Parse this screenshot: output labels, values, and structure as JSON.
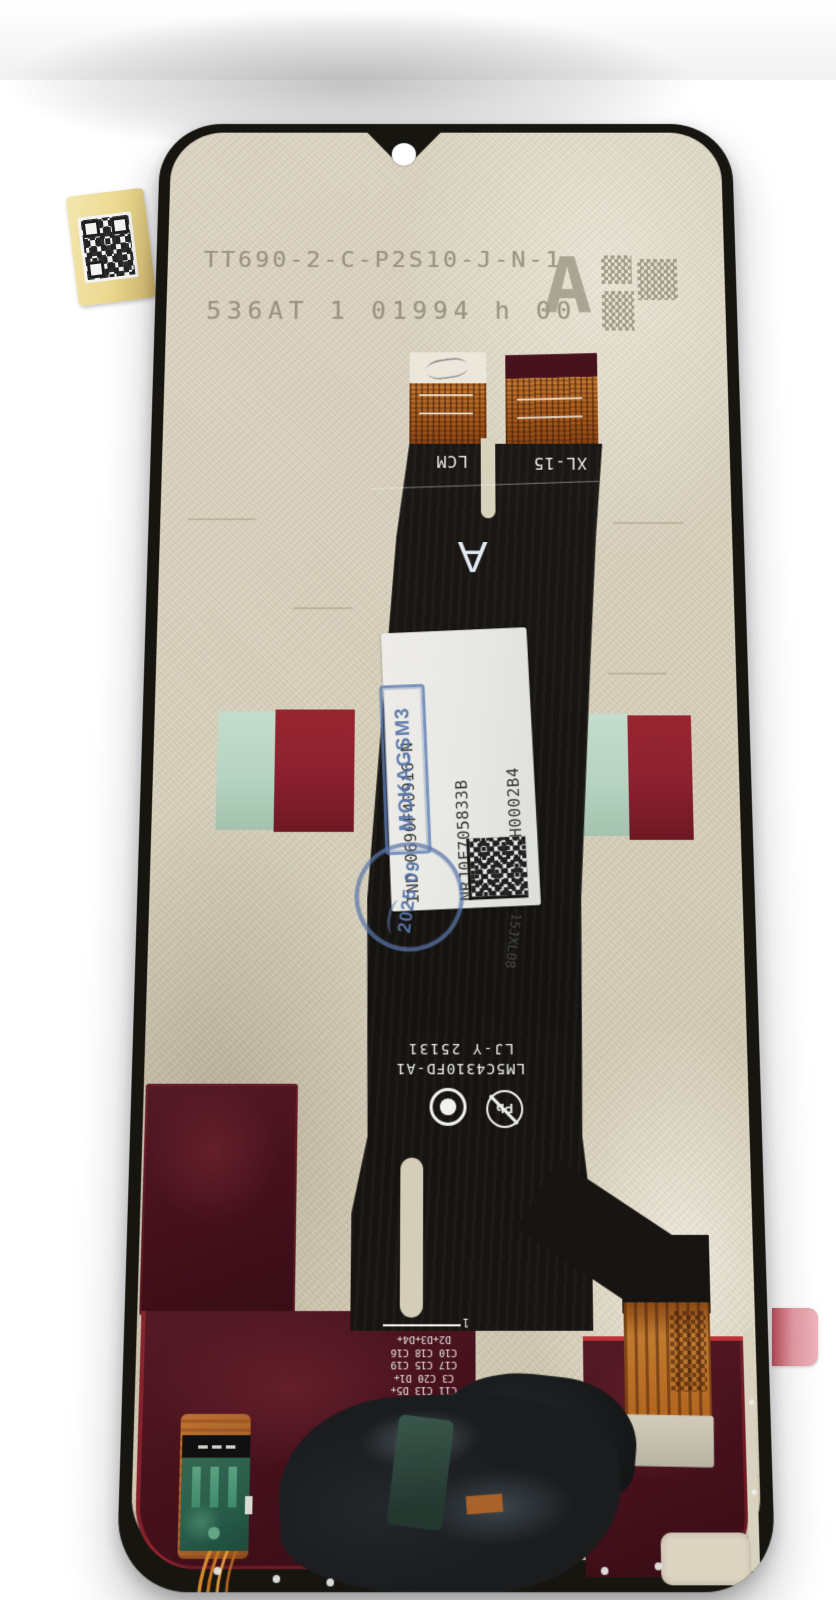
{
  "photo": {
    "subject": "phone-lcd-assembly-back",
    "top_print": {
      "line1": "TT690-2-C-P2S10-J-N-1",
      "line2": "536AT 1 01994 h 00",
      "grade_letter": "A"
    },
    "flex": {
      "tab_left_label": "LCM",
      "tab_right_label": "XL-15",
      "center_letter": "A",
      "faint_code": "15JXL08",
      "part_number": "LM5C4310FD-A1",
      "date_code": "LJ-Y 25131",
      "pb_mark": "Pb",
      "pin1_marker": "1",
      "component_labels": [
        "D2+D3+D4+",
        "C10 C18 C16",
        "C17 C15 C19",
        "C3 C20 D1+",
        "C11 C13 D5+",
        "C12 C1 C4 C14"
      ]
    },
    "service_label": {
      "line1": "IND-0690F40916-N",
      "line2": "NRJ0F705833B",
      "line3": "R7A000H0002B4",
      "stamp_box": "MOKAGSM3",
      "stamp_round": "2025.09"
    },
    "colors": {
      "plate": "#d6cfba",
      "bezel": "#17150f",
      "flex_black": "#171412",
      "copper": "#b2661f",
      "label_bg": "#e7e8e4",
      "stamp_blue": "#5d7cb2",
      "tape_red": "#8e2130",
      "tape_mint": "#b7d3c1",
      "panel_maroon": "#45101b",
      "panel_red_edge": "#c13236",
      "sticker_yellow": "#ecd88f",
      "pink_tab": "#e59aa4",
      "print_gray": "#968f7c"
    }
  }
}
